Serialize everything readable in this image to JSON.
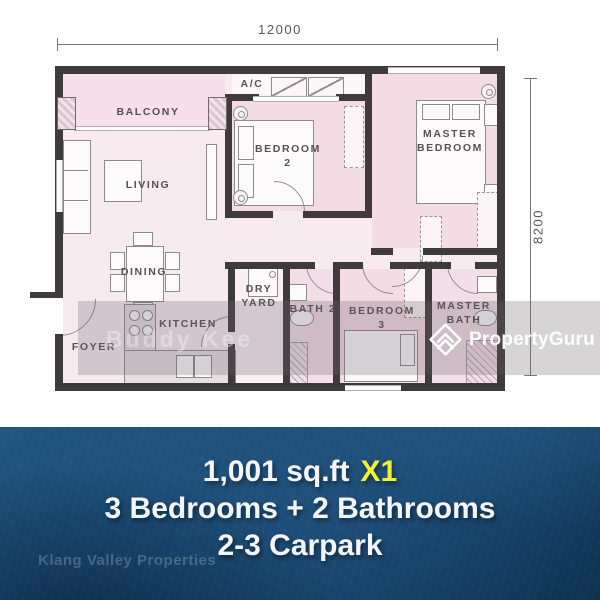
{
  "plan": {
    "dimension_width": "12000",
    "dimension_height": "8200",
    "rooms": {
      "balcony": "BALCONY",
      "living": "LIVING",
      "ac": "A/C",
      "bedroom2": "BEDROOM 2",
      "master_bedroom": "MASTER BEDROOM",
      "dining": "DINING",
      "dry_yard": "DRY YARD",
      "kitchen": "KITCHEN",
      "foyer": "FOYER",
      "bath2": "BATH 2",
      "bedroom3": "BEDROOM 3",
      "master_bath": "MASTER BATH"
    },
    "agent_watermark": "Buddy Kee"
  },
  "brand": {
    "name": "PropertyGuru"
  },
  "banner": {
    "area": "1,001 sq.ft",
    "quantity": "X1",
    "bedrooms_bathrooms": "3 Bedrooms + 2 Bathrooms",
    "carpark": "2-3 Carpark",
    "agency_watermark": "Klang Valley Properties"
  },
  "colors": {
    "accent_yellow": "#f2f32b",
    "banner_navy": "#1a4a74",
    "room_pink": "#f6e2ea",
    "wall_dark": "#3f3b3c"
  }
}
